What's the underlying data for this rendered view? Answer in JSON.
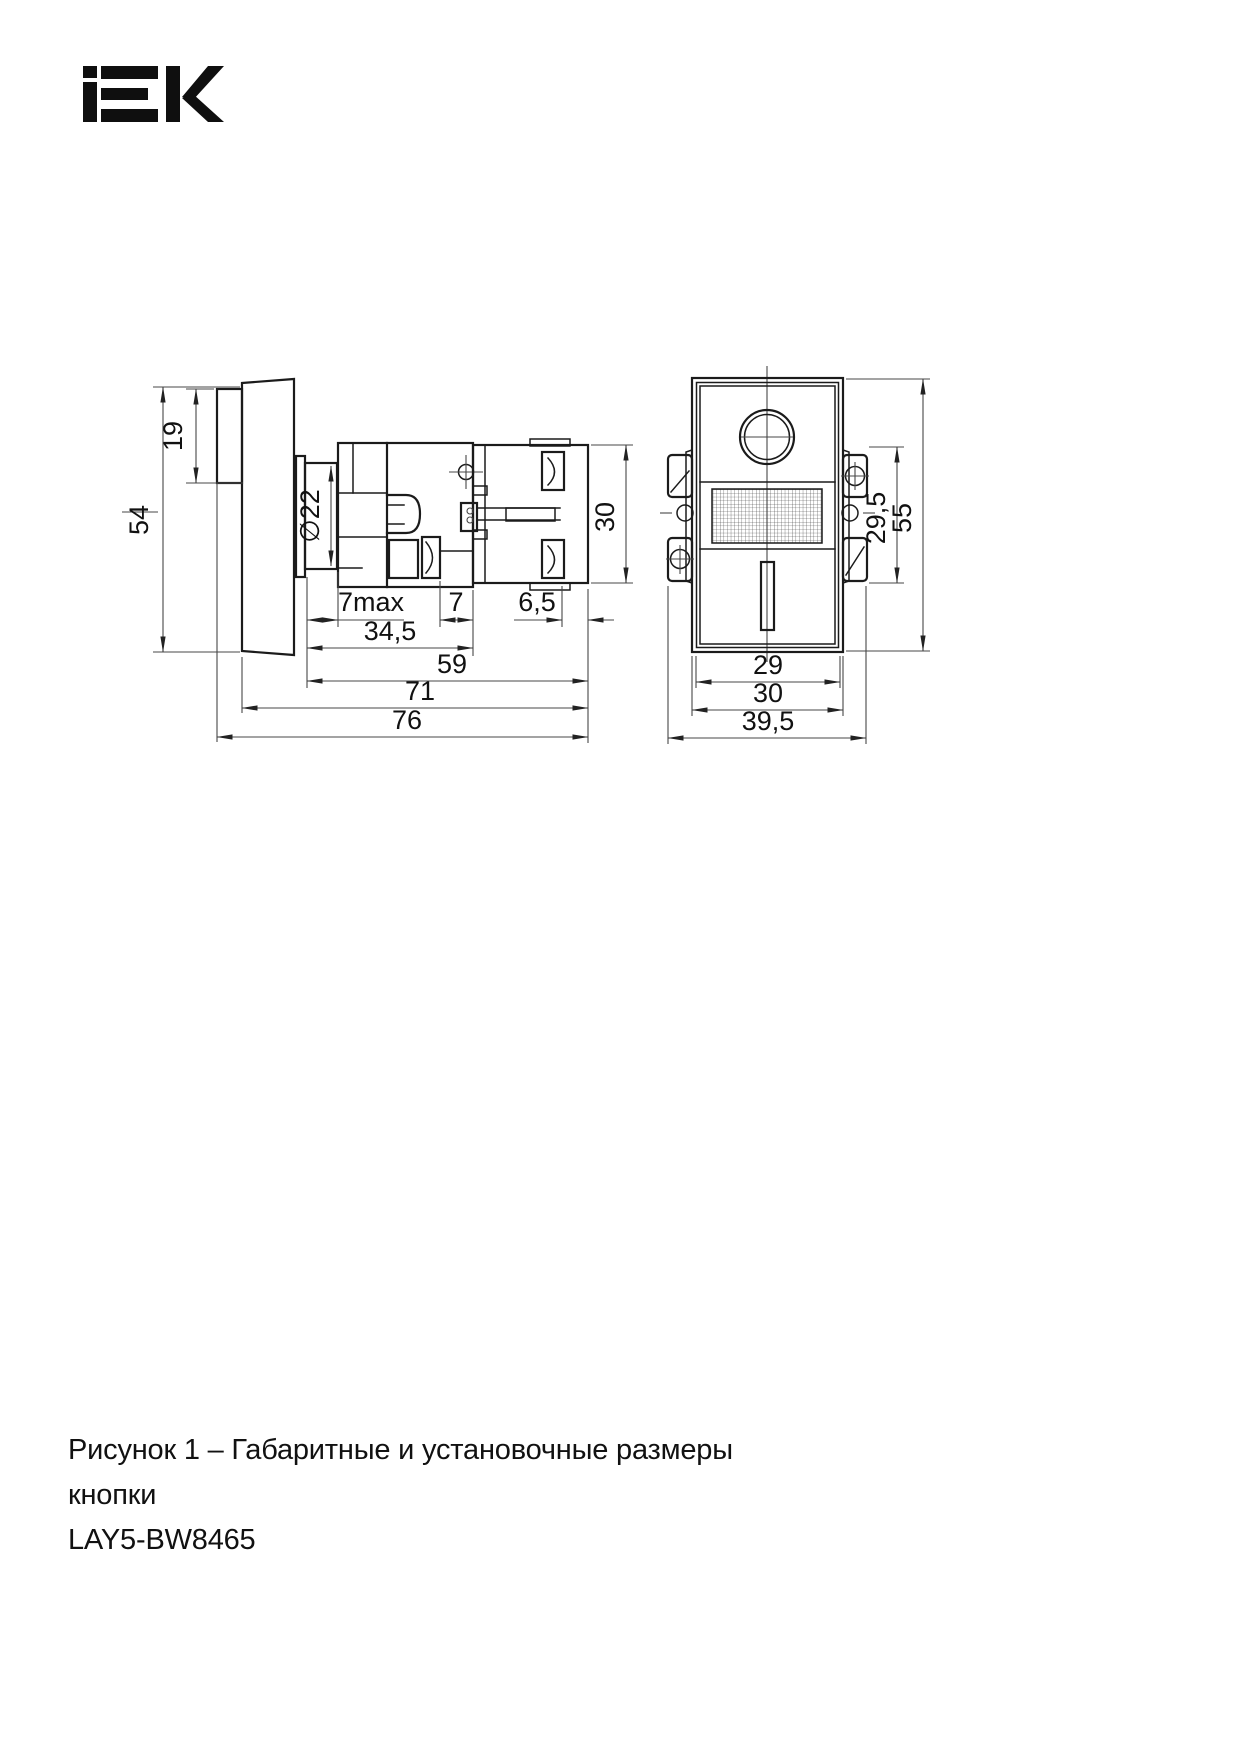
{
  "brand": {
    "name": "IEK"
  },
  "figure": {
    "caption_line1": "Рисунок 1 – Габаритные и установочные размеры кнопки",
    "caption_line2": "LAY5-BW8465"
  },
  "colors": {
    "outline": "#1b1b1b",
    "dimension": "#3a3a3a",
    "background": "#ffffff"
  },
  "side_view": {
    "dims": {
      "h54": "54",
      "h19": "19",
      "dia22": "∅22",
      "w7max": "7max",
      "w7": "7",
      "w6_5": "6,5",
      "w34_5": "34,5",
      "w59": "59",
      "w71": "71",
      "w76": "76",
      "h30": "30"
    }
  },
  "front_view": {
    "dims": {
      "h55": "55",
      "h29_5": "29,5",
      "w29": "29",
      "w30": "30",
      "w39_5": "39,5"
    }
  }
}
